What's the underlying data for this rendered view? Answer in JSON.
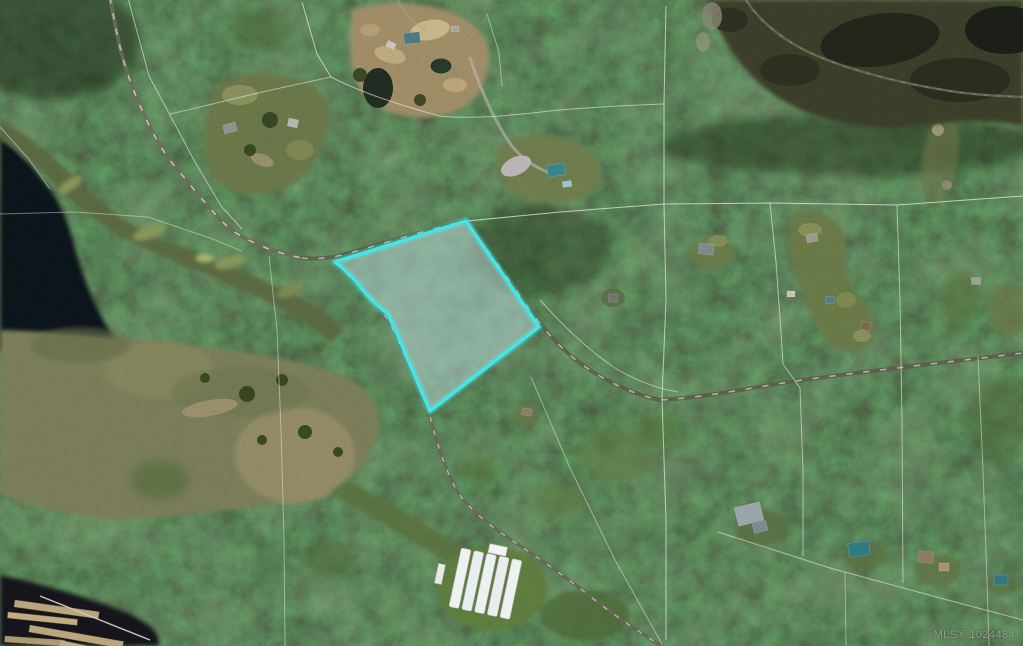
{
  "map": {
    "kind": "aerial-satellite-photo-with-parcel-overlay",
    "watermark": "MLS® 1024484",
    "colors": {
      "highlight_stroke": "#3fe8e8",
      "highlight_fill": "rgba(170,201,199,0.60)",
      "parcel_lines": "#eceadf"
    }
  }
}
